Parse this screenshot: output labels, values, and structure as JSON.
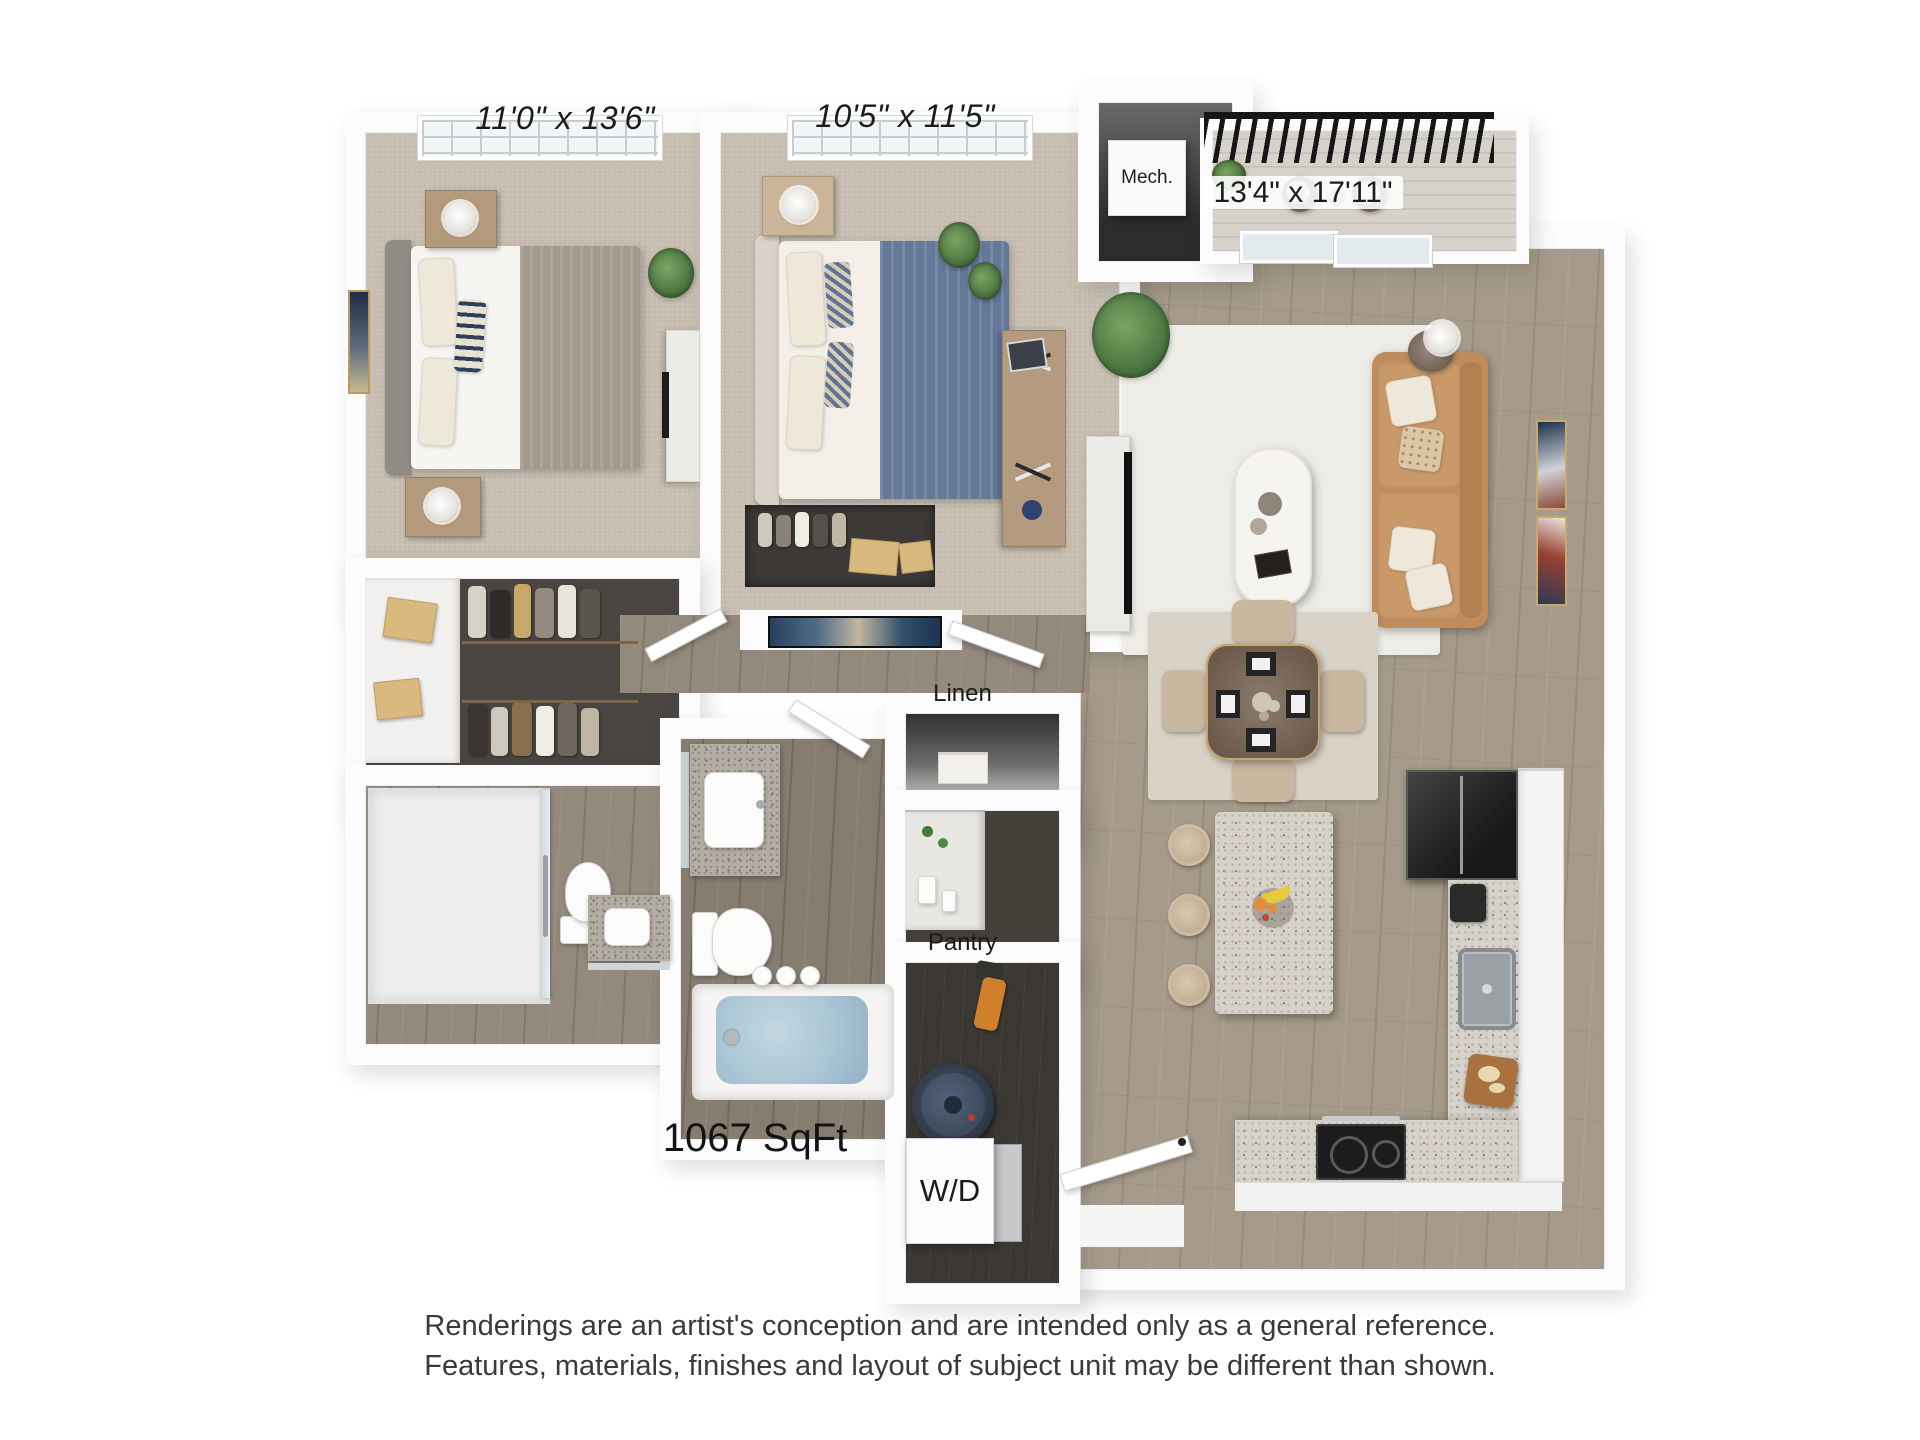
{
  "labels": {
    "bedroom1_dim": "11'0\" x 13'6\"",
    "bedroom2_dim": "10'5\" x 11'5\"",
    "living_dim": "13'4\" x 17'11\"",
    "mech": "Mech.",
    "linen": "Linen",
    "pantry": "Pantry",
    "laundry": "W/D",
    "area": "1067 SqFt"
  },
  "footer": {
    "line1": "Renderings are an artist's conception and are intended only as a general reference.",
    "line2": "Features, materials, finishes and layout of subject unit may be different than shown."
  },
  "colors": {
    "wall": "#fcfcfc",
    "carpet": "#c6bdb0",
    "wood_floor": "#a69b8a",
    "dark_wood_floor": "#93897c",
    "closet_floor": "#4a4540",
    "sofa_tan": "#c08c5c",
    "living_rug": "#edece6",
    "tub_water": "#a7c3d3",
    "granite": "#d6d2ca",
    "cabinet_white": "#f4f4f3",
    "fridge_black": "#262626",
    "water_heater_navy": "#3d4a5c",
    "railing_black": "#161616",
    "label_text": "#1b1b1b",
    "footer_text": "#3a3a3a"
  }
}
